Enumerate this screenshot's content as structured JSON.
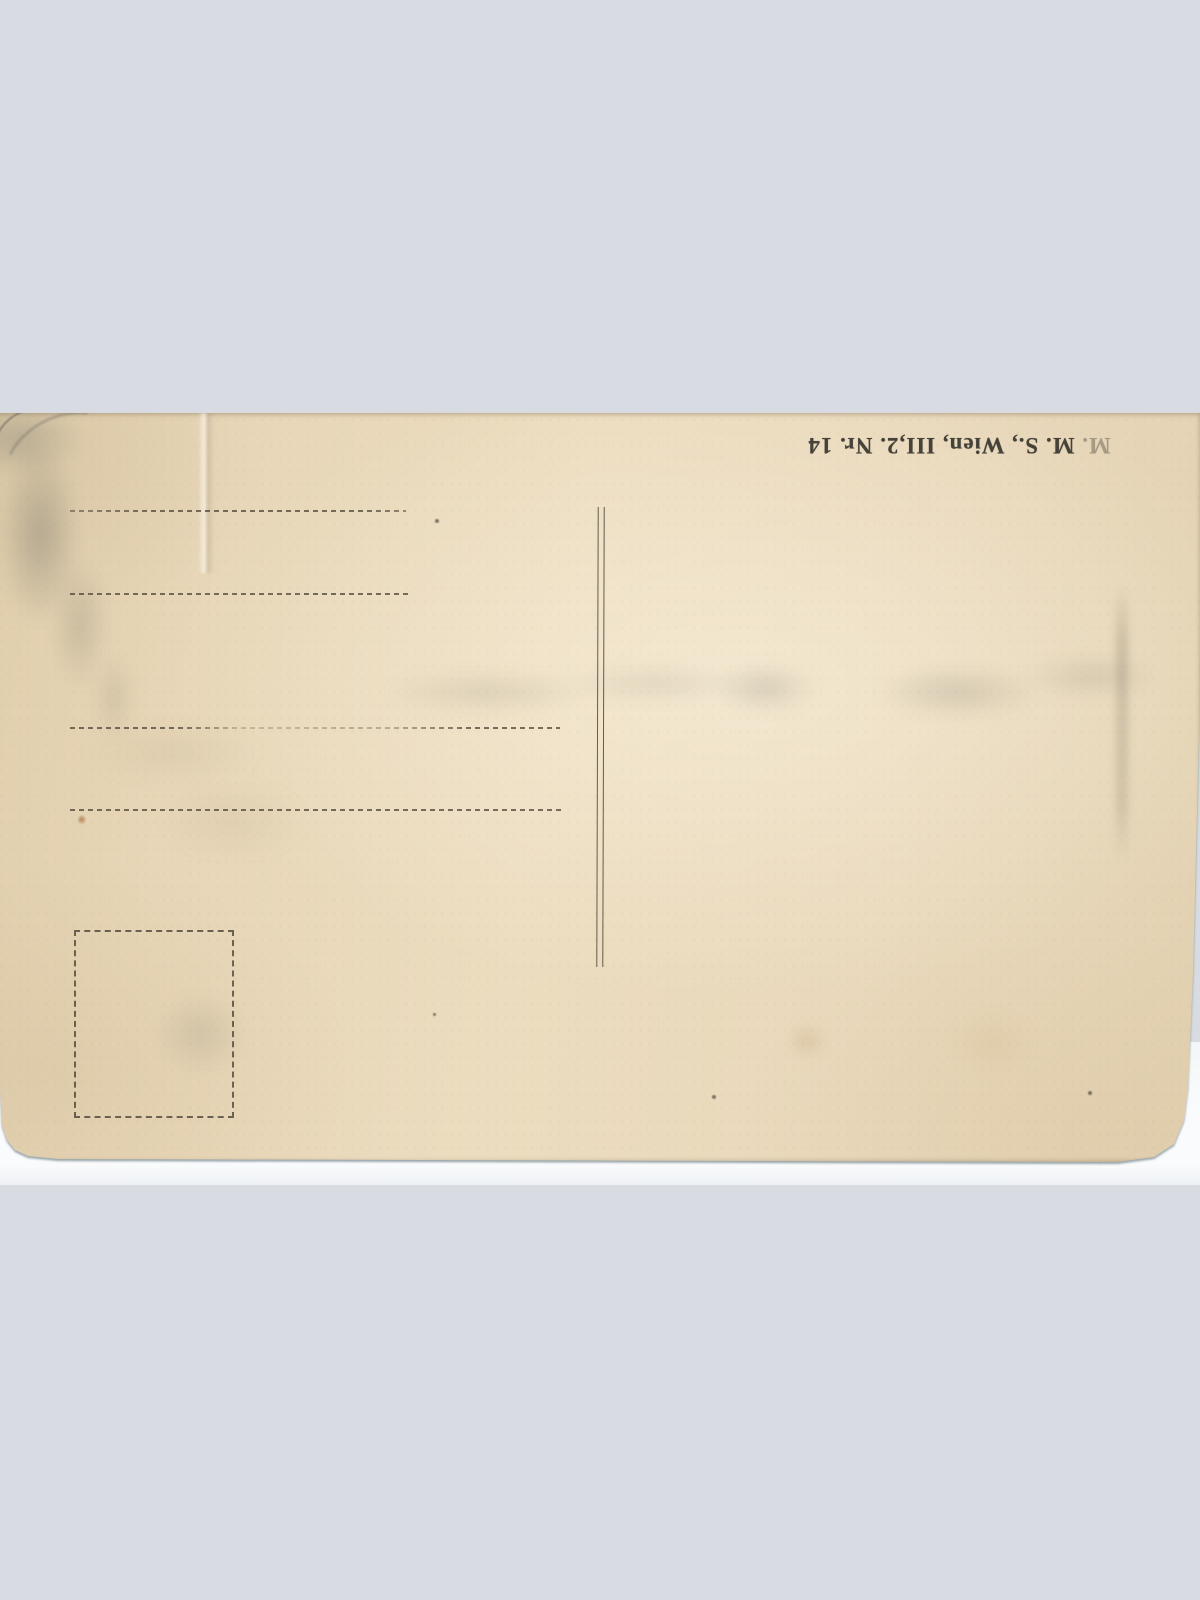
{
  "scan": {
    "background_color": "#d8dbe1",
    "scanner_strip_color": "#fafbfc"
  },
  "postcard": {
    "type": "blank postcard back, scanned upside-down",
    "paper_color": "#e9d8bb",
    "imprint": {
      "faint_prefix": "M.",
      "rest": " M. S., Wien, III,2. Nr. 14",
      "full_text": "M. M. S., Wien, III,2. Nr. 14",
      "ink_color": "#454239",
      "rotation_deg": 180
    },
    "divider": {
      "style": "double vertical line"
    },
    "address_lines": {
      "count": 4,
      "style": "dashed ruling, no text"
    },
    "stamp_box": {
      "style": "dashed square outline",
      "content": ""
    }
  }
}
